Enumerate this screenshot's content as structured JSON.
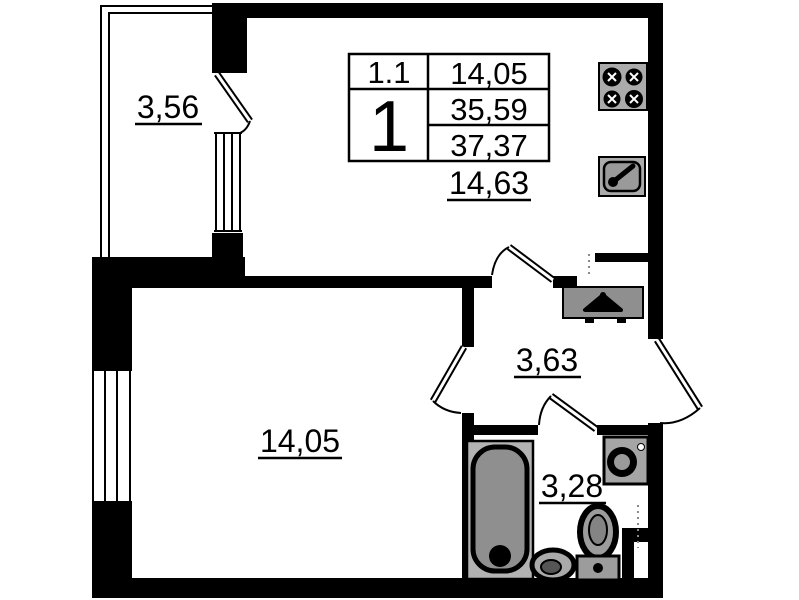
{
  "unit_info_table": {
    "row1_left": "1.1",
    "row1_right": "14,05",
    "rooms_count": "1",
    "area_mid": "35,59",
    "area_total": "37,37"
  },
  "room_areas": {
    "balcony": "3,56",
    "kitchen_living": "14,63",
    "living_room": "14,05",
    "hallway": "3,63",
    "bathroom": "3,28"
  },
  "icons": [
    "stove-icon",
    "kitchen-sink-icon",
    "hanger-icon",
    "bathtub-icon",
    "washbasin-icon",
    "toilet-icon",
    "washing-machine-icon"
  ],
  "colors": {
    "walls": "#000000",
    "fixtures": "#a6a6a6",
    "background": "#ffffff"
  }
}
